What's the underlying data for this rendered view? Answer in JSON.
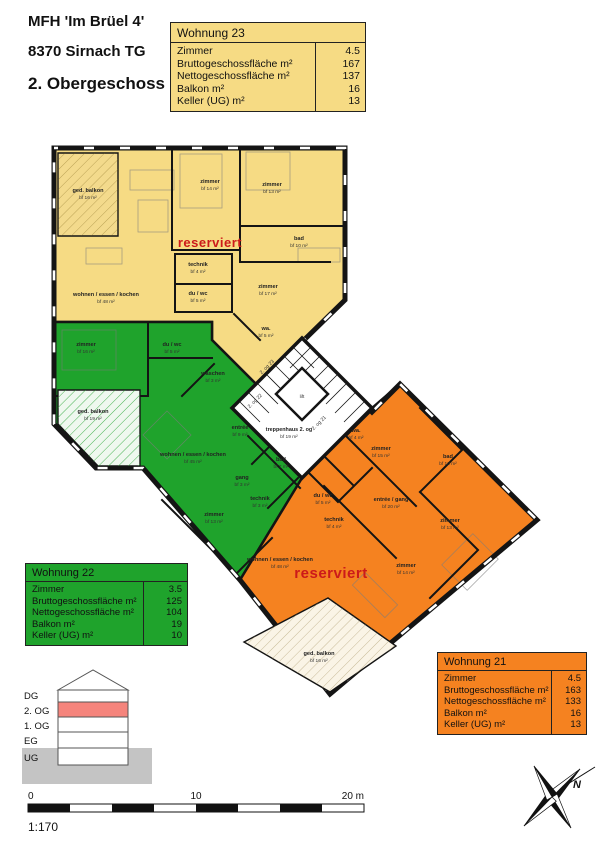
{
  "document": {
    "title_line1": "MFH 'Im Brüel 4'",
    "title_line2": "8370 Sirnach TG",
    "title_line3": "2. Obergeschoss"
  },
  "colors": {
    "w23": "#F6DB84",
    "w22": "#1FA32C",
    "w21": "#F58220",
    "reserved": "#CC1A1A",
    "highlight_floor": "#F5847C",
    "ground": "#C4C4C4",
    "wall": "#141414"
  },
  "apartments": {
    "w23": {
      "title": "Wohnung 23",
      "status": "reserviert",
      "rows": [
        {
          "label": "Zimmer",
          "value": "4.5"
        },
        {
          "label": "Bruttogeschossfläche m²",
          "value": "167"
        },
        {
          "label": "Nettogeschossfläche m²",
          "value": "137"
        },
        {
          "label": "Balkon m²",
          "value": "16"
        },
        {
          "label": "Keller (UG) m²",
          "value": "13"
        }
      ]
    },
    "w22": {
      "title": "Wohnung 22",
      "rows": [
        {
          "label": "Zimmer",
          "value": "3.5"
        },
        {
          "label": "Bruttogeschossfläche m²",
          "value": "125"
        },
        {
          "label": "Nettogeschossfläche m²",
          "value": "104"
        },
        {
          "label": "Balkon m²",
          "value": "19"
        },
        {
          "label": "Keller (UG) m²",
          "value": "10"
        }
      ]
    },
    "w21": {
      "title": "Wohnung 21",
      "status": "reserviert",
      "rows": [
        {
          "label": "Zimmer",
          "value": "4.5"
        },
        {
          "label": "Bruttogeschossfläche m²",
          "value": "163"
        },
        {
          "label": "Nettogeschossfläche m²",
          "value": "133"
        },
        {
          "label": "Balkon m²",
          "value": "16"
        },
        {
          "label": "Keller (UG) m²",
          "value": "13"
        }
      ]
    }
  },
  "plan": {
    "w23_rooms": [
      {
        "n": "ged. balkon",
        "a": "bf 16 m²"
      },
      {
        "n": "wohnen / essen / kochen",
        "a": "bf 48 m²"
      },
      {
        "n": "zimmer",
        "a": "bf 14 m²"
      },
      {
        "n": "zimmer",
        "a": "bf 13 m²"
      },
      {
        "n": "bad",
        "a": "bf 10 m²"
      },
      {
        "n": "technik",
        "a": "bf 4 m²"
      },
      {
        "n": "du / wc",
        "a": "bf 5 m²"
      },
      {
        "n": "zimmer",
        "a": "bf 17 m²"
      },
      {
        "n": "wa.",
        "a": "bf 5 m²"
      }
    ],
    "w22_rooms": [
      {
        "n": "zimmer",
        "a": "bf 16 m²"
      },
      {
        "n": "du / wc",
        "a": "bf 5 m²"
      },
      {
        "n": "waschen",
        "a": "bf 3 m²"
      },
      {
        "n": "ged. balkon",
        "a": "bf 19 m²"
      },
      {
        "n": "wohnen / essen / kochen",
        "a": "bf 45 m²"
      },
      {
        "n": "bad",
        "a": "bf 7 m²"
      },
      {
        "n": "gang",
        "a": "bf 3 m²"
      },
      {
        "n": "technik",
        "a": "bf 3 m²"
      },
      {
        "n": "zimmer",
        "a": "bf 13 m²"
      },
      {
        "n": "entrée",
        "a": "bf 9 m²"
      }
    ],
    "w21_rooms": [
      {
        "n": "wa.",
        "a": "bf 4 m²"
      },
      {
        "n": "zimmer",
        "a": "bf 15 m²"
      },
      {
        "n": "bad",
        "a": "bf 10 m²"
      },
      {
        "n": "entrée / gang",
        "a": "bf 20 m²"
      },
      {
        "n": "zimmer",
        "a": "bf 13 m²"
      },
      {
        "n": "du / wc",
        "a": "bf 5 m²"
      },
      {
        "n": "technik",
        "a": "bf 4 m²"
      },
      {
        "n": "zimmer",
        "a": "bf 14 m²"
      },
      {
        "n": "wohnen / essen / kochen",
        "a": "bf 48 m²"
      },
      {
        "n": "ged. balkon",
        "a": "bf 16 m²"
      }
    ],
    "stairs": {
      "name": "treppenhaus 2. og",
      "area": "bf 19 m²",
      "lift": "lift",
      "door23": "2. og 23",
      "door22": "2. og 22",
      "door21": "2. og 21"
    }
  },
  "section": {
    "floors": [
      "DG",
      "2. OG",
      "1. OG",
      "EG",
      "UG"
    ],
    "highlighted": "2. OG"
  },
  "scalebar": {
    "tick0": "0",
    "tick10": "10",
    "tick20": "20 m",
    "ratio": "1:170"
  },
  "compass": {
    "label": "N"
  }
}
